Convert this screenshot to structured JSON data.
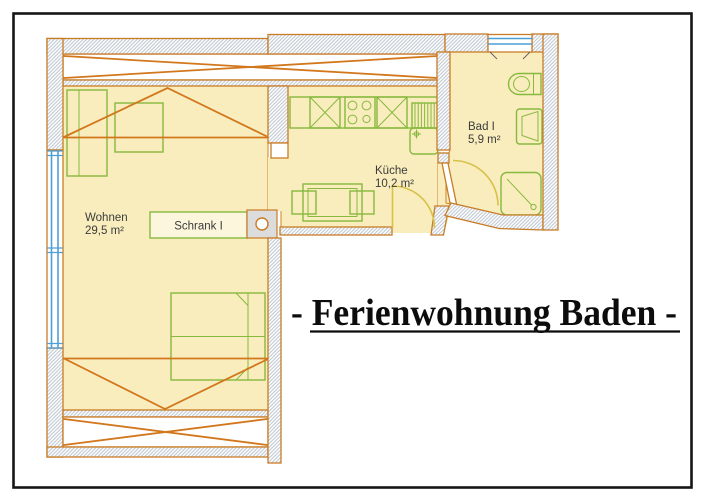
{
  "title": {
    "text": "- Ferienwohnung Baden -"
  },
  "rooms": {
    "wohnen": {
      "name": "Wohnen",
      "area": "29,5 m²"
    },
    "kueche": {
      "name": "Küche",
      "area": "10,2 m²"
    },
    "bad": {
      "name": "Bad I",
      "area": "5,9 m²"
    },
    "schrank": {
      "name": "Schrank I"
    }
  },
  "colors": {
    "wall_outline": "#c87c26",
    "structure_lines": "#d2771c",
    "floor_fill": "#f9edbd",
    "furniture_green": "#87b93f",
    "window_blue": "#4f9fd4",
    "door_swing_yellow": "#d8c14b",
    "frame_black": "#161616",
    "chimney_block_gray": "#dcdcdc"
  },
  "fixtures": [
    "sofa",
    "side-table",
    "double-bed",
    "wardrobe",
    "kitchen-counter",
    "stove",
    "sink",
    "radiator",
    "dining-table",
    "chairs",
    "toilet",
    "washbasin",
    "shower",
    "windows",
    "door-swings",
    "chimney-block"
  ]
}
